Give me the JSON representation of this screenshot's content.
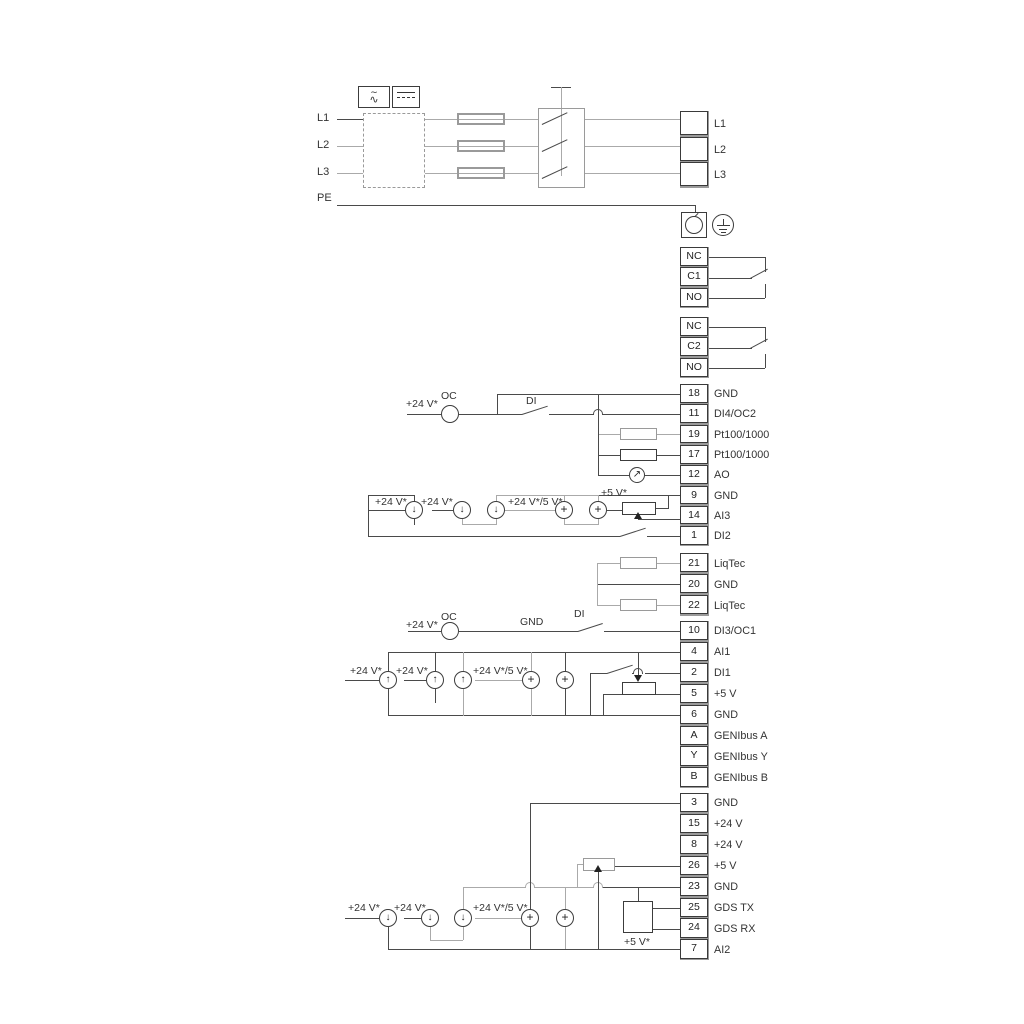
{
  "diagram_title": "drive-terminal-wiring-diagram",
  "power": {
    "left": [
      "L1",
      "L2",
      "L3",
      "PE"
    ],
    "right": [
      "L1",
      "L2",
      "L3"
    ]
  },
  "blocks": {
    "relay1": {
      "rows": [
        {
          "n": "NC",
          "label": ""
        },
        {
          "n": "C1",
          "label": ""
        },
        {
          "n": "NO",
          "label": ""
        }
      ]
    },
    "relay2": {
      "rows": [
        {
          "n": "NC",
          "label": ""
        },
        {
          "n": "C2",
          "label": ""
        },
        {
          "n": "NO",
          "label": ""
        }
      ]
    },
    "io1": {
      "rows": [
        {
          "n": "18",
          "label": "GND"
        },
        {
          "n": "11",
          "label": "DI4/OC2"
        },
        {
          "n": "19",
          "label": "Pt100/1000"
        },
        {
          "n": "17",
          "label": "Pt100/1000"
        },
        {
          "n": "12",
          "label": "AO"
        },
        {
          "n": "9",
          "label": "GND"
        },
        {
          "n": "14",
          "label": "AI3"
        },
        {
          "n": "1",
          "label": "DI2"
        }
      ]
    },
    "liqtec": {
      "rows": [
        {
          "n": "21",
          "label": "LiqTec"
        },
        {
          "n": "20",
          "label": "GND"
        },
        {
          "n": "22",
          "label": "LiqTec"
        }
      ]
    },
    "io2": {
      "rows": [
        {
          "n": "10",
          "label": "DI3/OC1"
        },
        {
          "n": "4",
          "label": "AI1"
        },
        {
          "n": "2",
          "label": "DI1"
        },
        {
          "n": "5",
          "label": "+5 V"
        },
        {
          "n": "6",
          "label": "GND"
        },
        {
          "n": "A",
          "label": "GENIbus A"
        },
        {
          "n": "Y",
          "label": "GENIbus Y"
        },
        {
          "n": "B",
          "label": "GENIbus B"
        }
      ]
    },
    "io3": {
      "rows": [
        {
          "n": "3",
          "label": "GND"
        },
        {
          "n": "15",
          "label": "+24 V"
        },
        {
          "n": "8",
          "label": "+24 V"
        },
        {
          "n": "26",
          "label": "+5 V"
        },
        {
          "n": "23",
          "label": "GND"
        },
        {
          "n": "25",
          "label": "GDS TX"
        },
        {
          "n": "24",
          "label": "GDS RX"
        },
        {
          "n": "7",
          "label": "AI2"
        }
      ]
    },
    "power_right": {
      "rows": [
        {
          "n": "",
          "label": "L1"
        },
        {
          "n": "",
          "label": "L2"
        },
        {
          "n": "",
          "label": "L3"
        }
      ]
    }
  },
  "labels": {
    "p24": "+24 V*",
    "p24_5": "+24 V*/5 V*",
    "p5": "+5 V*",
    "oc": "OC",
    "di": "DI",
    "gnd": "GND"
  },
  "symbols": {
    "ac_tilde": "∼",
    "ac_wave": "∿"
  }
}
